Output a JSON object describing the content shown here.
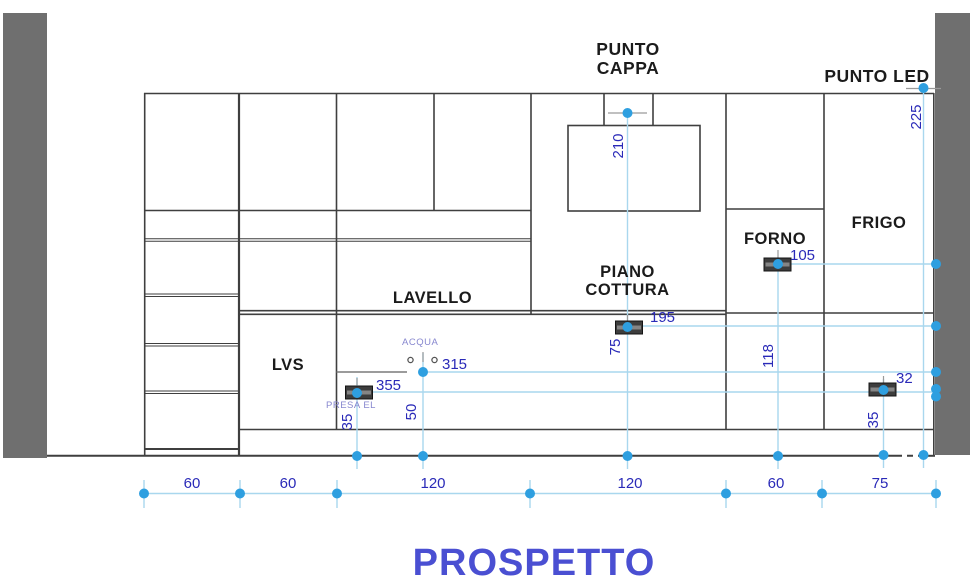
{
  "title": "PROSPETTO",
  "colors": {
    "wall": "#6f6f6f",
    "line": "#3f3f3f",
    "line_soft": "#7a7a7a",
    "crosshair": "#9a9a9a",
    "dim_line": "#a9d7ee",
    "dim_dot": "#2e9fe0",
    "dim_text": "#2a2ab8",
    "label_text": "#1b1b1b",
    "utility_text": "#8787cf",
    "title_text": "#4a4fd2",
    "socket_fill": "#3d3d3d"
  },
  "labels": {
    "punto_cappa_line1": "PUNTO",
    "punto_cappa_line2": "CAPPA",
    "punto_led": "PUNTO LED",
    "forno": "FORNO",
    "frigo": "FRIGO",
    "piano_cottura_line1": "PIANO",
    "piano_cottura_line2": "COTTURA",
    "lavello": "LAVELLO",
    "lvs": "LVS",
    "acqua": "ACQUA",
    "presa_el": "PRESA EL"
  },
  "dimensions": {
    "hood_point_height": "210",
    "led_point_height": "225",
    "forno_socket_run": "105",
    "cooktop_socket_run": "195",
    "cooktop_socket_height": "75",
    "forno_socket_height": "118",
    "acqua_run": "315",
    "presa_run": "355",
    "acqua_height": "50",
    "presa_height": "35",
    "frigo_socket_gap": "32",
    "frigo_socket_height": "35",
    "bottom": [
      {
        "value": "60"
      },
      {
        "value": "60"
      },
      {
        "value": "120"
      },
      {
        "value": "120"
      },
      {
        "value": "60"
      },
      {
        "value": "75"
      }
    ]
  }
}
